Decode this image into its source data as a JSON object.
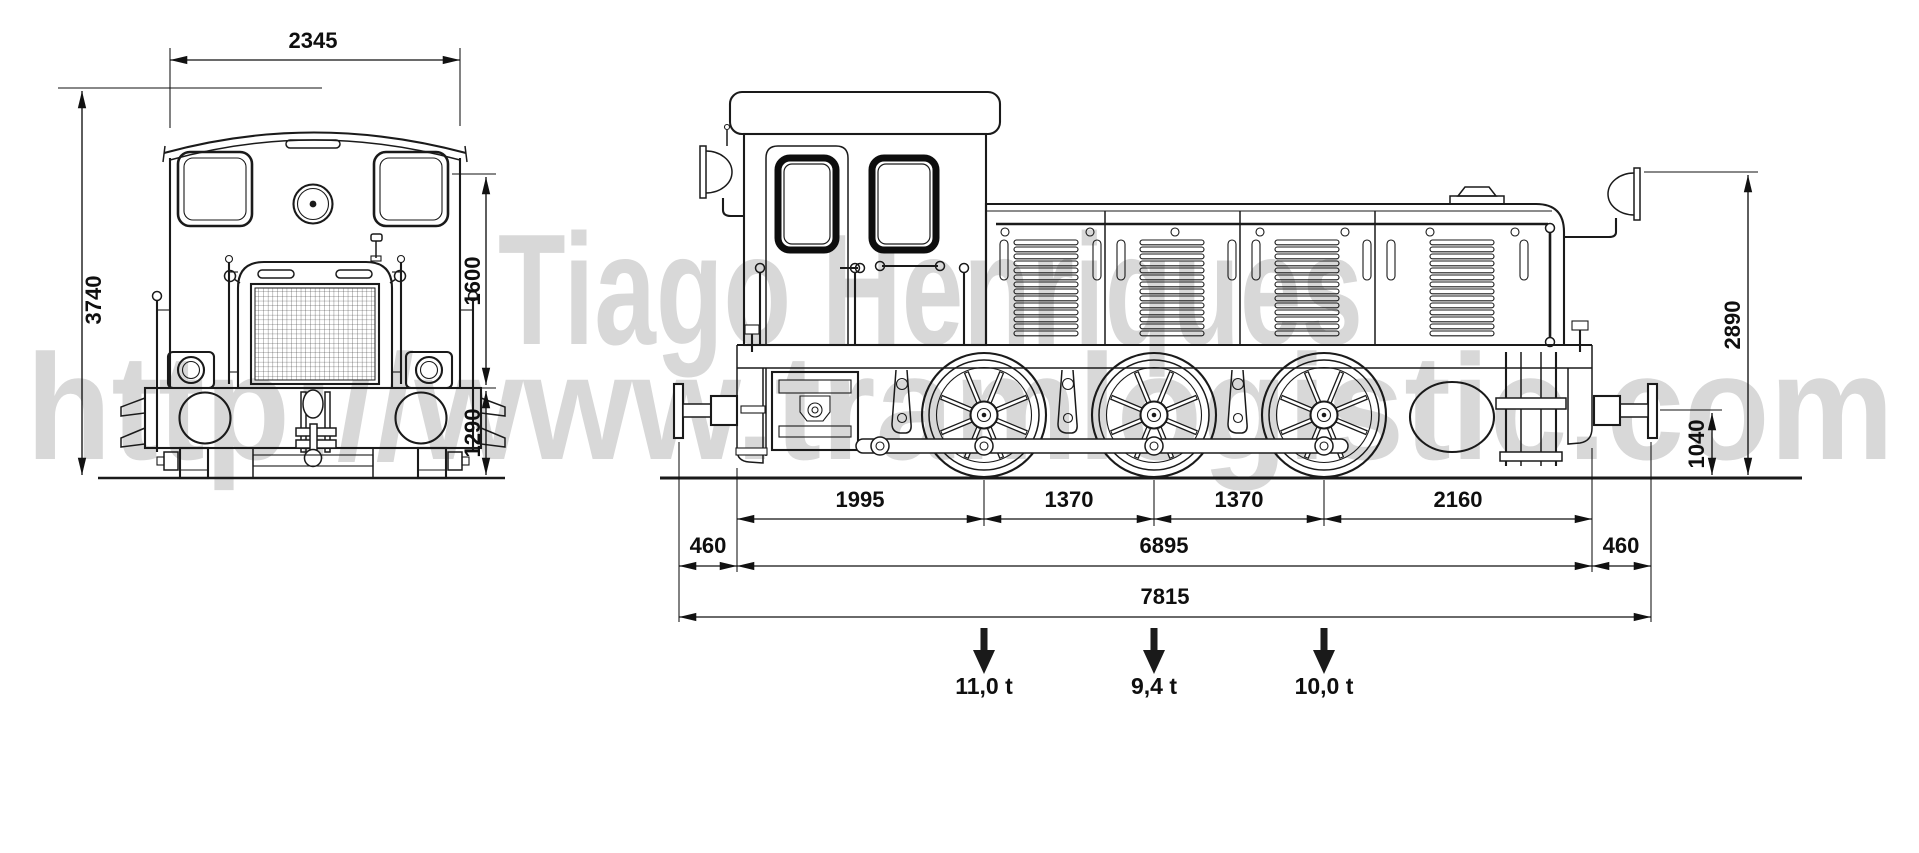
{
  "watermark": {
    "line1": "Tiago Henriques",
    "line2": "http://www.tramlogistic.com"
  },
  "front_view": {
    "dim_width": "2345",
    "dim_height_total": "3740",
    "dim_height_upper": "1600",
    "dim_height_lower": "1290"
  },
  "side_view": {
    "dim_axle_spacing_1": "1995",
    "dim_axle_spacing_2": "1370",
    "dim_axle_spacing_3": "1370",
    "dim_axle_spacing_4": "2160",
    "dim_overhang_left": "460",
    "dim_frame_length": "6895",
    "dim_overhang_right": "460",
    "dim_total_length": "7815",
    "dim_height_total": "2890",
    "dim_buffer_height": "1040",
    "axle_loads": [
      "11,0 t",
      "9,4 t",
      "10,0 t"
    ]
  },
  "colors": {
    "line": "#1a1a1a",
    "dimension": "#111111",
    "watermark": "#d8d8d8"
  }
}
